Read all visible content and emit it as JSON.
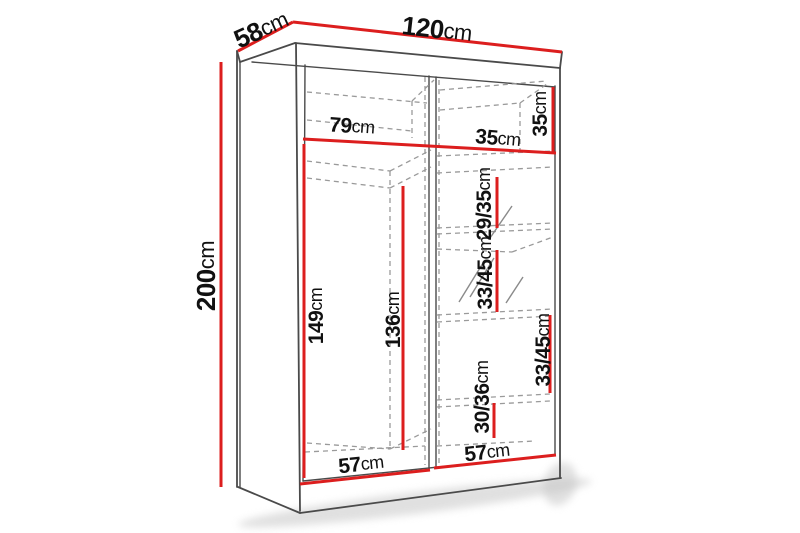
{
  "diagram_type": "wardrobe-dimension-drawing",
  "colors": {
    "measure_line": "#dc1e1e",
    "outline": "#4a4a4a",
    "hidden_line": "#9a9a9a",
    "label_text": "#111111",
    "background": "#ffffff"
  },
  "measurements": {
    "width": {
      "value": "120",
      "unit": "cm"
    },
    "depth": {
      "value": "58",
      "unit": "cm"
    },
    "height": {
      "value": "200",
      "unit": "cm"
    },
    "top_shelf_left": {
      "value": "79",
      "unit": "cm"
    },
    "top_shelf_right": {
      "value": "35",
      "unit": "cm"
    },
    "top_compartment": {
      "value": "35",
      "unit": "cm"
    },
    "hanging_left": {
      "value": "149",
      "unit": "cm"
    },
    "hanging_middle": {
      "value": "136",
      "unit": "cm"
    },
    "gap_29_35": {
      "value": "29/35",
      "unit": "cm"
    },
    "gap_33_45_mid": {
      "value": "33/45",
      "unit": "cm"
    },
    "gap_33_45_right": {
      "value": "33/45",
      "unit": "cm"
    },
    "gap_30_36": {
      "value": "30/36",
      "unit": "cm"
    },
    "door_left_width": {
      "value": "57",
      "unit": "cm"
    },
    "door_right_width": {
      "value": "57",
      "unit": "cm"
    }
  }
}
